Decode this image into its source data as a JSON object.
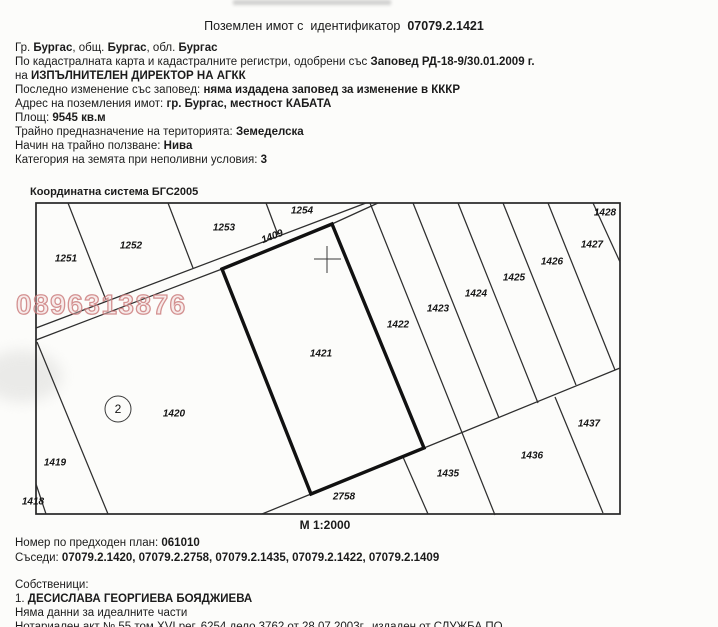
{
  "header": {
    "title_normal": "Поземлен имот с  идентификатор  ",
    "title_bold": "07079.2.1421"
  },
  "info_lines": [
    [
      {
        "t": "Гр. ",
        "b": false
      },
      {
        "t": "Бургас",
        "b": true
      },
      {
        "t": ", общ. ",
        "b": false
      },
      {
        "t": "Бургас",
        "b": true
      },
      {
        "t": ", обл. ",
        "b": false
      },
      {
        "t": "Бургас",
        "b": true
      }
    ],
    [
      {
        "t": "По кадастралната карта и кадастралните регистри, одобрени със ",
        "b": false
      },
      {
        "t": "Заповед РД-18-9/30.01.2009 г.",
        "b": true
      }
    ],
    [
      {
        "t": "на ",
        "b": false
      },
      {
        "t": "ИЗПЪЛНИТЕЛЕН ДИРЕКТОР НА АГКК",
        "b": true
      }
    ],
    [
      {
        "t": "Последно изменение със заповед: ",
        "b": false
      },
      {
        "t": "няма издадена заповед за изменение в КККР",
        "b": true
      }
    ],
    [
      {
        "t": "Адрес на поземления имот: ",
        "b": false
      },
      {
        "t": "гр. Бургас, местност КАБАТА",
        "b": true
      }
    ],
    [
      {
        "t": "Площ: ",
        "b": false
      },
      {
        "t": "9545 кв.м",
        "b": true
      }
    ],
    [
      {
        "t": "Трайно предназначение на територията: ",
        "b": false
      },
      {
        "t": "Земеделска",
        "b": true
      }
    ],
    [
      {
        "t": "Начин на трайно ползване: ",
        "b": false
      },
      {
        "t": "Нива",
        "b": true
      }
    ],
    [
      {
        "t": "Категория на земята при неполивни условия: ",
        "b": false
      },
      {
        "t": "3",
        "b": true
      }
    ]
  ],
  "coordinate_system": "Координатна система БГС2005",
  "map": {
    "scale_label": "М 1:2000",
    "watermark": "0896313876",
    "watermark_color": "#c97878",
    "highlighted_parcel": "1421",
    "zone_circle": {
      "label": "2",
      "x": 118,
      "y": 409
    },
    "parcels": [
      {
        "id": "1251",
        "x": 66,
        "y": 258
      },
      {
        "id": "1252",
        "x": 131,
        "y": 245
      },
      {
        "id": "1253",
        "x": 224,
        "y": 227
      },
      {
        "id": "1254",
        "x": 302,
        "y": 210
      },
      {
        "id": "1409",
        "x": 272,
        "y": 236,
        "rot": -21
      },
      {
        "id": "1421",
        "x": 321,
        "y": 353
      },
      {
        "id": "1420",
        "x": 174,
        "y": 413
      },
      {
        "id": "1419",
        "x": 55,
        "y": 462
      },
      {
        "id": "1418",
        "x": 33,
        "y": 501
      },
      {
        "id": "1422",
        "x": 398,
        "y": 324
      },
      {
        "id": "1423",
        "x": 438,
        "y": 308
      },
      {
        "id": "1424",
        "x": 476,
        "y": 293
      },
      {
        "id": "1425",
        "x": 514,
        "y": 277
      },
      {
        "id": "1426",
        "x": 552,
        "y": 261
      },
      {
        "id": "1427",
        "x": 592,
        "y": 244
      },
      {
        "id": "1428",
        "x": 605,
        "y": 212
      },
      {
        "id": "1437",
        "x": 589,
        "y": 423
      },
      {
        "id": "1436",
        "x": 532,
        "y": 455
      },
      {
        "id": "1435",
        "x": 448,
        "y": 473
      },
      {
        "id": "2758",
        "x": 344,
        "y": 496
      }
    ]
  },
  "footer_top_lines": [
    [
      {
        "t": "Номер по предходен план: ",
        "b": false
      },
      {
        "t": "061010",
        "b": true
      }
    ],
    [
      {
        "t": "Съседи: ",
        "b": false
      },
      {
        "t": "07079.2.1420, 07079.2.2758, 07079.2.1435, 07079.2.1422, 07079.2.1409",
        "b": true
      }
    ]
  ],
  "footer_bottom_lines": [
    [
      {
        "t": "Собственици:",
        "b": false
      }
    ],
    [
      {
        "t": "1. ",
        "b": false
      },
      {
        "t": "ДЕСИСЛАВА ГЕОРГИЕВА БОЯДЖИЕВА",
        "b": true
      }
    ],
    [
      {
        "t": "Няма данни за идеалните части",
        "b": false
      }
    ],
    [
      {
        "t": "Нотариален акт № 55 том XVI рег. 6254 дело 3762 от 28.07.2003г., издаден от СЛУЖБА ПО",
        "b": false
      }
    ]
  ]
}
